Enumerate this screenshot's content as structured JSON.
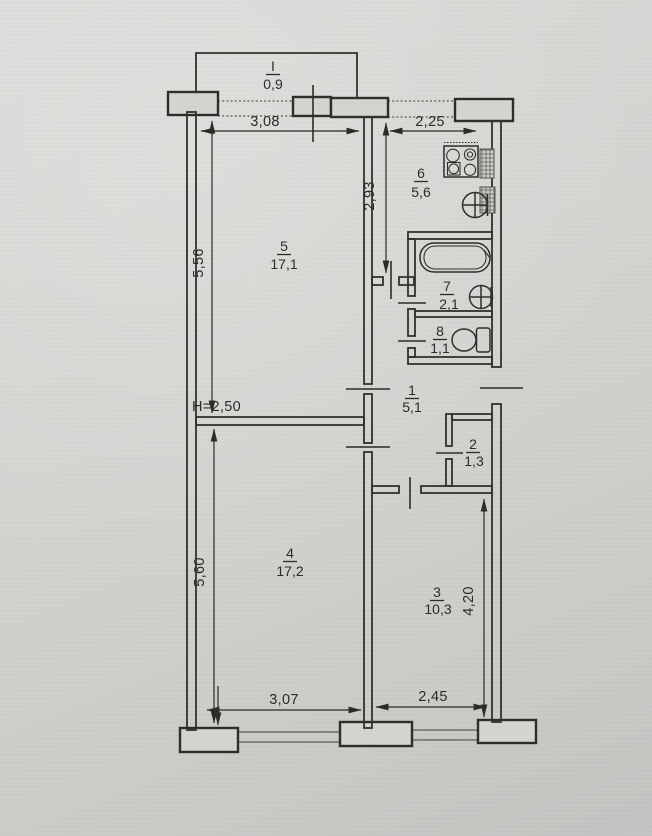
{
  "document": {
    "kind": "apartment floor plan (scanned technical drawing)"
  },
  "rooms": {
    "balcony": {
      "number": "I",
      "area": "0,9"
    },
    "room1": {
      "number": "1",
      "area": "5,1"
    },
    "room2": {
      "number": "2",
      "area": "1,3"
    },
    "room3": {
      "number": "3",
      "area": "10,3"
    },
    "room4": {
      "number": "4",
      "area": "17,2"
    },
    "room5": {
      "number": "5",
      "area": "17,1"
    },
    "room6": {
      "number": "6",
      "area": "5,6"
    },
    "room7": {
      "number": "7",
      "area": "2,1"
    },
    "room8": {
      "number": "8",
      "area": "1,1"
    }
  },
  "dimensions": {
    "top_left": "3,08",
    "top_right": "2,25",
    "kitchen_vertical": "2,93",
    "left_upper": "5,56",
    "left_lower": "5,60",
    "right_lower": "4,20",
    "bottom_left": "3,07",
    "bottom_right": "2,45",
    "ceiling_height": "H=2,50"
  },
  "fixtures": {
    "kitchen_stove": "stove-4-burner-icon",
    "kitchen_sink": "sink-icon",
    "bathtub": "bathtub-icon",
    "bathroom_sink": "sink-icon",
    "toilet": "toilet-icon",
    "ventilation": "ventilation-shaft-icon"
  },
  "colors": {
    "paper": "#d6d4d1",
    "ink": "#2c2a27"
  }
}
